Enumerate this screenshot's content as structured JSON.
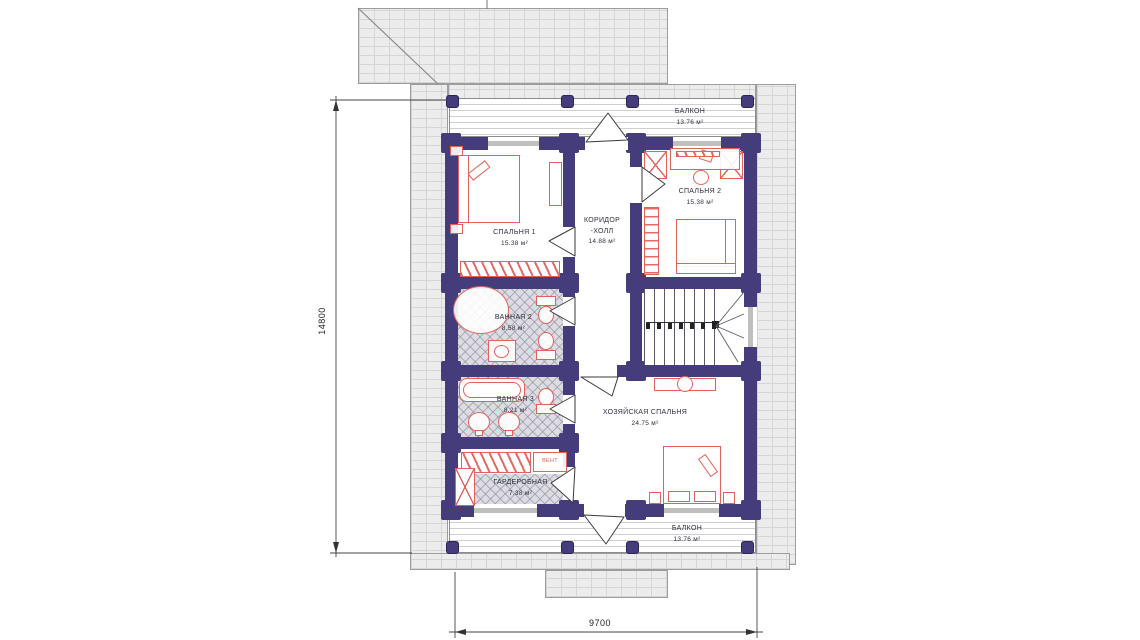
{
  "plan": {
    "rooms": {
      "bedroom1": {
        "name": "СПАЛЬНЯ 1",
        "area": "15.38 м²"
      },
      "bedroom2": {
        "name": "СПАЛЬНЯ 2",
        "area": "15.38 м²"
      },
      "corridor": {
        "name": "КОРИДОР",
        "name2": "-ХОЛЛ",
        "area": "14.88 м²"
      },
      "bathroom2": {
        "name": "ВАННАЯ 2",
        "area": "8.58 м²"
      },
      "bathroom3": {
        "name": "ВАННАЯ 3",
        "area": "8.21 м²"
      },
      "master_bedroom": {
        "name": "ХОЗЯЙСКАЯ СПАЛЬНЯ",
        "area": "24.75 м²"
      },
      "wardrobe": {
        "name": "ГАРДЕРОБНАЯ",
        "area": "7.38 м²"
      },
      "balcony_top": {
        "name": "БАЛКОН",
        "area": "13.76 м²"
      },
      "balcony_bottom": {
        "name": "БАЛКОН",
        "area": "13.76 м²"
      }
    },
    "annotations": {
      "vent": "ВЕНТ"
    },
    "dimensions": {
      "height_mm": "14800",
      "width_mm": "9700"
    },
    "colors": {
      "wall": "#443c7b",
      "furniture": "#e2625a",
      "roof": "#ececec",
      "tile": "#dcdce2"
    }
  }
}
